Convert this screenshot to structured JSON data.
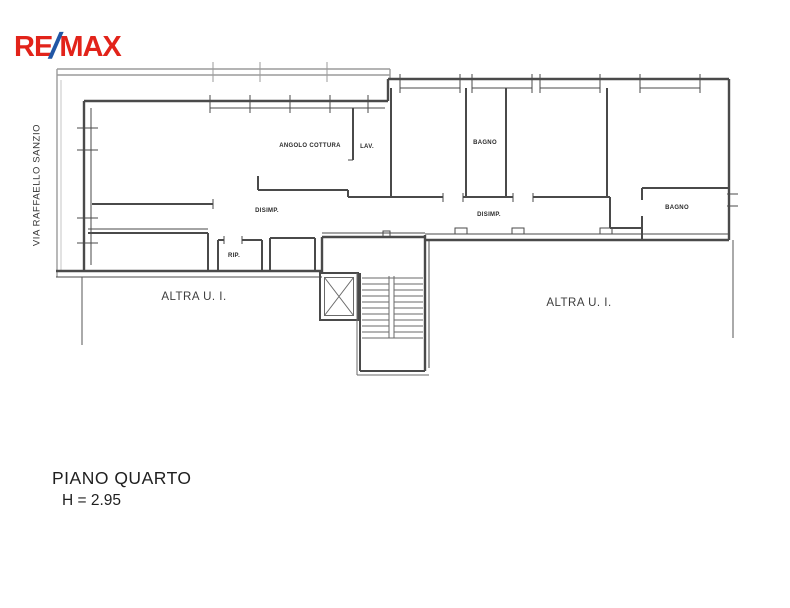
{
  "logo": {
    "re": "RE",
    "slash": "/",
    "max": "MAX",
    "red": "#E2231A",
    "blue": "#2156A5"
  },
  "street_label": "VIA RAFFAELLO SANZIO",
  "plan": {
    "line_color": "#4a4a4a",
    "balcony_color": "#9b9b9b",
    "rooms": {
      "kitchen": "ANGOLO COTTURA",
      "laundry": "LAV.",
      "bath1": "BAGNO",
      "hall_left": "DISIMP.",
      "hall_right": "DISIMP.",
      "bath2": "BAGNO",
      "storage": "RIP.",
      "other_unit_left": "ALTRA U. I.",
      "other_unit_right": "ALTRA U. I."
    }
  },
  "title": {
    "line1": "PIANO QUARTO",
    "line2": "H = 2.95"
  }
}
